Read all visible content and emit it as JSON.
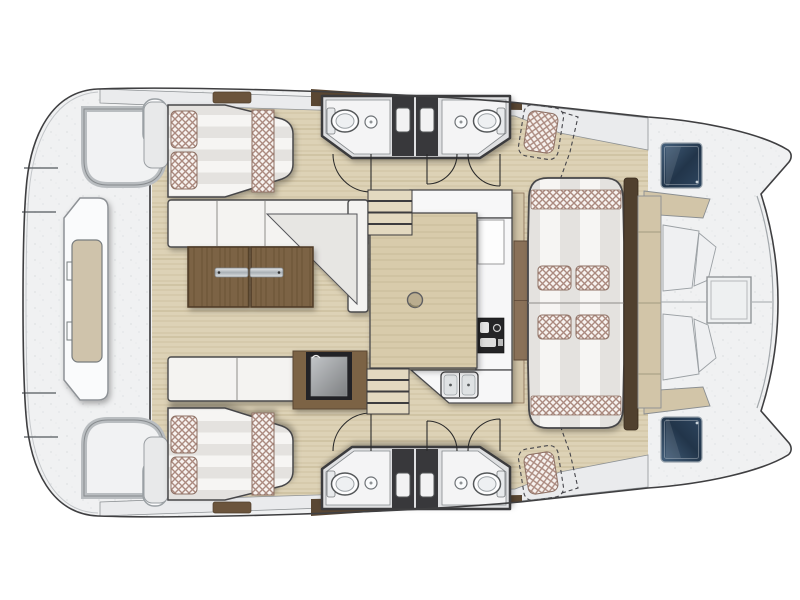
{
  "meta": {
    "diagram_type": "boat-floor-plan",
    "vessel": "catamaran",
    "view": "overhead-deck-plan",
    "bow_direction": "right",
    "stern_direction": "left"
  },
  "colors": {
    "background": "#ffffff",
    "hull_outline": "#3f3f41",
    "deck_surface": "#f0f1f2",
    "deck_speckle": "#e3e5e7",
    "side_deck": "#eaebed",
    "interior_floor": "#ddd2b6",
    "floor_grain": "#cfc2a2",
    "wood_furniture": "#7c6344",
    "wood_grain_dark": "#6b5336",
    "island_wood": "#d8cbab",
    "island_grain": "#c9bb98",
    "trim_brown": "#5a4733",
    "trim_brown_dark": "#50402e",
    "trim_light_brown": "#8a7158",
    "tan_trim": "#d2c5a8",
    "upholstery": "#f6f5f3",
    "upholstery_stripe": "#e4e2df",
    "cushion_base": "#f7f2ef",
    "cushion_checker": "#ab8a7f",
    "hatch_navy": "#22354a",
    "hatch_navy_light": "#44607c",
    "hatch_navy_mid": "#2e4660",
    "shower_dark": "#38383b",
    "counter_white": "#f7f7f8",
    "appliance_dark": "#242426",
    "steel_light": "#e8ebed",
    "steel_dark": "#a9b0b5",
    "bow_cushion": "#d2c5a8",
    "door_line": "#2b2b2b"
  },
  "components": {
    "stern_platform": {
      "features": [
        "swim-platform",
        "tender-pod",
        "transom-cutouts",
        "grab-handles",
        "railing-lines"
      ]
    },
    "aft_cabins": [
      {
        "id": "port-aft-cabin",
        "berth": "double",
        "pillows": 2,
        "bedding": "striped-mattress-checkered-runner"
      },
      {
        "id": "starboard-aft-cabin",
        "berth": "double",
        "pillows": 2,
        "bedding": "striped-mattress-checkered-runner"
      }
    ],
    "heads": [
      {
        "id": "port-outboard-head",
        "fixtures": [
          "toilet",
          "washbasin"
        ]
      },
      {
        "id": "port-inboard-head",
        "fixtures": [
          "toilet",
          "washbasin"
        ]
      },
      {
        "id": "starboard-inboard-head",
        "fixtures": [
          "toilet",
          "washbasin"
        ]
      },
      {
        "id": "starboard-outboard-head",
        "fixtures": [
          "toilet",
          "washbasin"
        ]
      }
    ],
    "shower_stalls": {
      "count": 4
    },
    "door_swings": {
      "count": 6
    },
    "salon": {
      "sofa": "L-shaped",
      "sofa_seats": 3,
      "table": {
        "type": "wood-double-leaf",
        "leaves": 2,
        "metal_handles": 2
      },
      "bench": {
        "seats": 2
      },
      "cooler_box": 1
    },
    "galley": {
      "island": 1,
      "double_sink": 1,
      "stove": 1,
      "counter": "L-shaped",
      "stairs": {
        "flights": 2,
        "steps_per_flight": 4
      }
    },
    "forward_lounge": {
      "sunbed_sections": 2,
      "throw_cushions": 4,
      "checkered_bands": 2,
      "side_tables": 2,
      "mast_beam": 1
    },
    "helm_stations": {
      "count": 2,
      "style": "dashed-outline",
      "seat": "checkered-cushion"
    },
    "bow": {
      "hull_hatches": 2,
      "deck_hatch": 1,
      "seat_pads": 4,
      "backrests": 4
    }
  }
}
